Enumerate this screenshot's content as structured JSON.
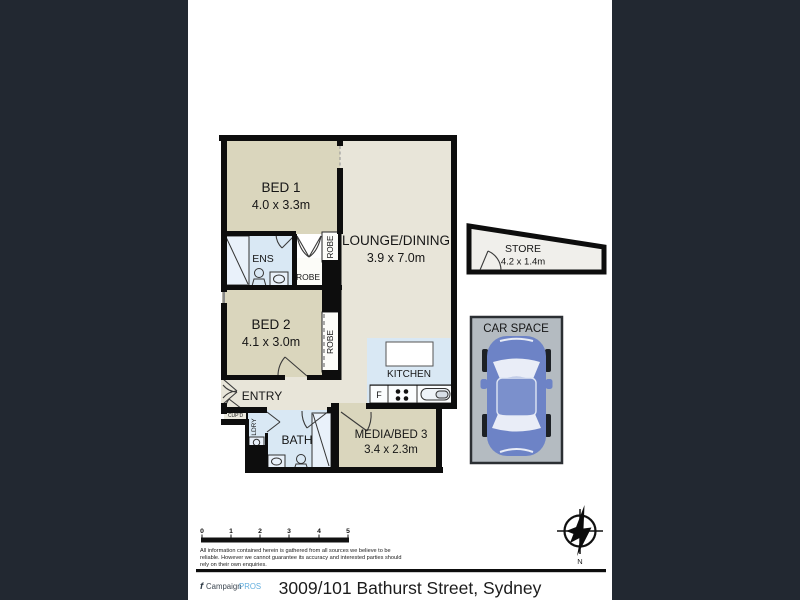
{
  "footer": {
    "title": "3009/101 Bathurst Street, Sydney",
    "logo_f": "f",
    "logo_campaign": "Campaign",
    "logo_pros": "PROS"
  },
  "plan": {
    "rooms": {
      "bed1": {
        "name": "BED 1",
        "dims": "4.0 x 3.3m"
      },
      "bed2": {
        "name": "BED 2",
        "dims": "4.1 x 3.0m"
      },
      "lounge": {
        "name": "LOUNGE/DINING",
        "dims": "3.9 x 7.0m"
      },
      "media": {
        "name": "MEDIA/BED 3",
        "dims": "3.4 x 2.3m"
      },
      "store": {
        "name": "STORE",
        "dims": "4.2 x 1.4m"
      },
      "kitchen": {
        "name": "KITCHEN"
      },
      "entry": {
        "name": "ENTRY"
      },
      "bath": {
        "name": "BATH"
      },
      "ens": {
        "name": "ENS"
      },
      "robe_top": {
        "name": "ROBE"
      },
      "robe_mid": {
        "name": "ROBE"
      },
      "robe_bed2": {
        "name": "ROBE"
      },
      "ldry": {
        "name": "LDRY"
      },
      "cupd": {
        "name": "CUP'D"
      },
      "carspace": {
        "name": "CAR SPACE"
      },
      "fridge": {
        "name": "F"
      }
    }
  },
  "scalebar": {
    "ticks": [
      "0",
      "1",
      "2",
      "3",
      "4",
      "5"
    ]
  },
  "compass": {
    "north_label": "N"
  },
  "disclaimer": {
    "line1": "All information contained herein is gathered from all sources we believe to be",
    "line2": "reliable. However we cannot guarantee its accuracy and interested parties should",
    "line3": "rely on their own enquiries."
  },
  "colors": {
    "panel": "#222831",
    "room_tan": "#dad6bd",
    "room_light": "#e8e5d9",
    "wet_blue": "#d9e8f4",
    "fixture_blue": "#e9f1fa",
    "robe_white": "#fcfcf8",
    "store_fill": "#f0efeb",
    "carspace_fill": "#b4bbc1",
    "car_blue": "#6d83c6",
    "car_roof": "#7b90cc",
    "car_glass": "#e9edf7",
    "wall": "#0d0d0d",
    "logo_blue": "#62aede"
  }
}
